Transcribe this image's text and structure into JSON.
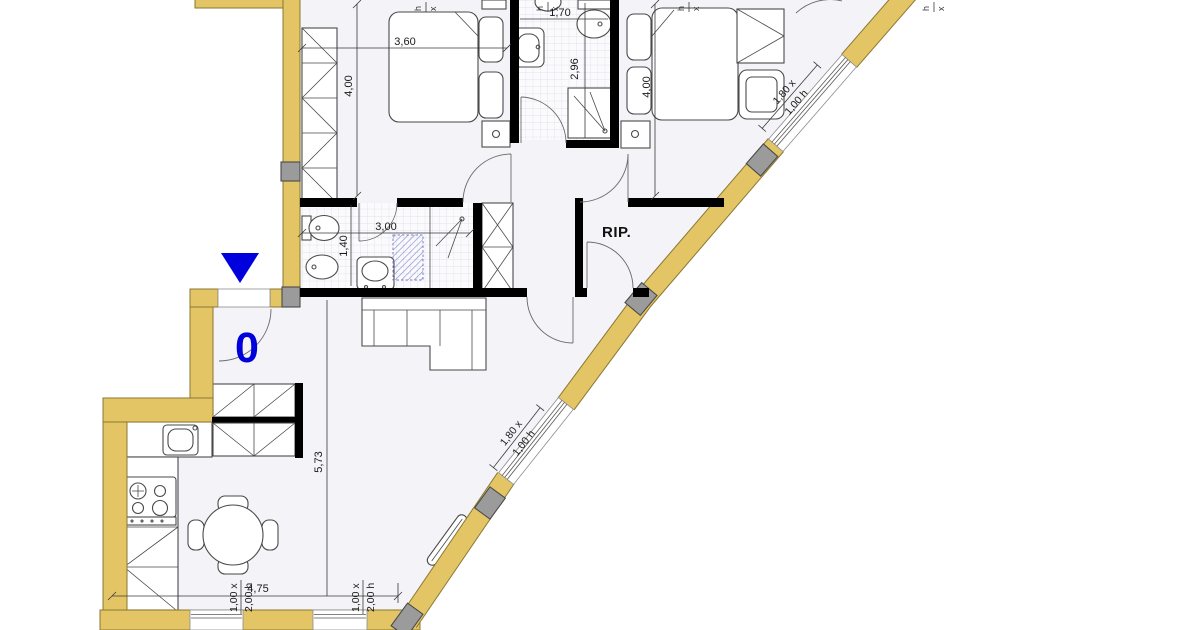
{
  "plan": {
    "entry_marker": "0",
    "storage_label": "RIP.",
    "dims": {
      "bedroom1_width": "3,60",
      "bedroom1_depth": "4,00",
      "bathroom1_width": "1,70",
      "bathroom1_depth": "2,96",
      "bedroom2_depth": "4,00",
      "bathroom2_width": "3,00",
      "bathroom2_depth": "1,40",
      "living_depth": "5,73",
      "kitchen_width": "4,75"
    },
    "windows": {
      "upper_diagonal": {
        "l1": "1,80 x",
        "l2": "1,00 h"
      },
      "lower_diagonal": {
        "l1": "1,80 x",
        "l2": "1,00 h"
      },
      "kitchen_left": {
        "l1": "1,00 x",
        "l2": "2,00 h"
      },
      "kitchen_right": {
        "l1": "1,00 x",
        "l2": "2,00 h"
      }
    },
    "edge_marks": {
      "h": "h",
      "x": "x"
    },
    "colors": {
      "exterior_wall": "#e3c566",
      "wall_outline": "#8a7732",
      "interior_wall": "#000000",
      "pillar": "#9b9b9b",
      "floor": "#f3f3f8",
      "tile_line": "#d9dae6",
      "furniture_line": "#4a4a4a",
      "dimension_text": "#1a1a1a",
      "marker_blue": "#0000dd",
      "hatch_blue": "#7b7fc7",
      "outside": "#ffffff"
    }
  }
}
